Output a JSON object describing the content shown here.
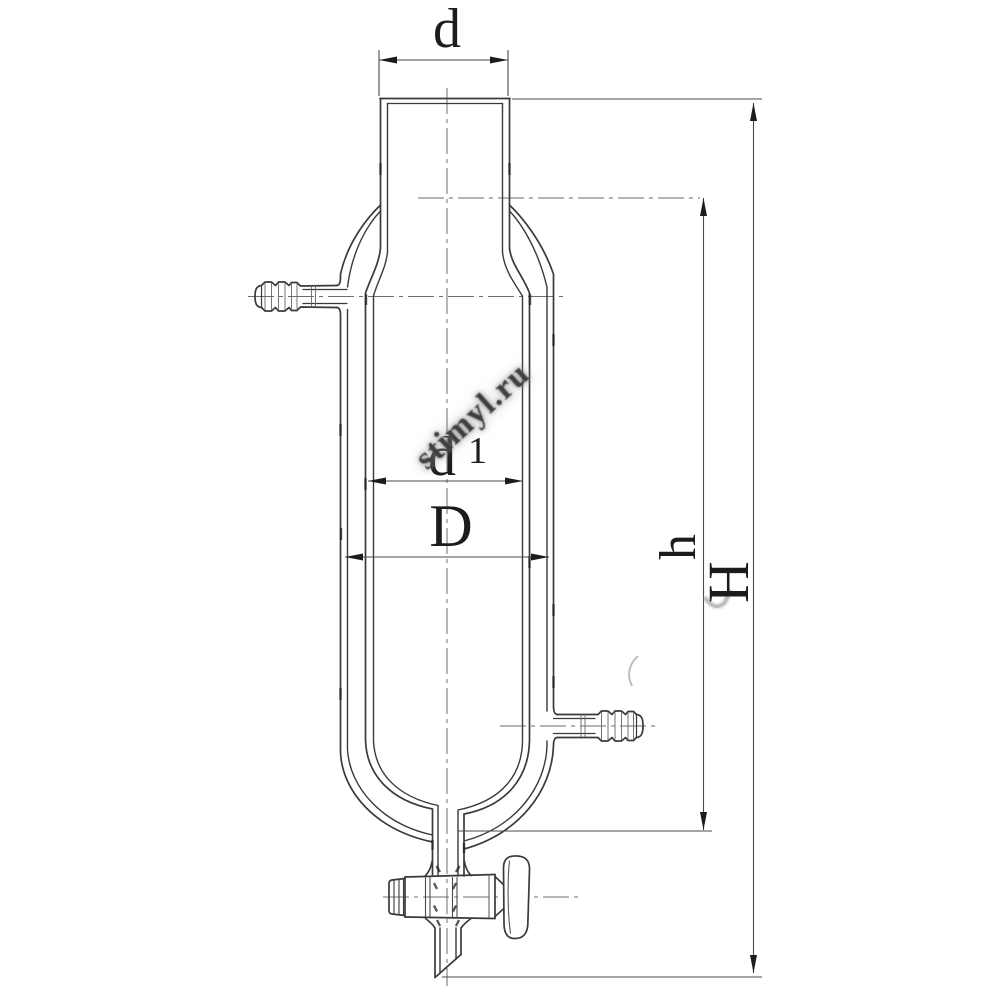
{
  "drawing": {
    "labels": {
      "neck_diameter": "d",
      "inner_diameter": "d",
      "inner_diameter_index": "1",
      "body_diameter": "D",
      "vessel_height": "h",
      "total_height": "H"
    },
    "watermark": "stimyl.ru",
    "colors": {
      "line": "#3a3a3a",
      "dim_line": "#4a4a4a",
      "centerline": "#6e6e6e",
      "tick": "#222222",
      "label_text": "#1c1c1c",
      "watermark_text": "#3f3f3f",
      "background": "#ffffff"
    }
  }
}
